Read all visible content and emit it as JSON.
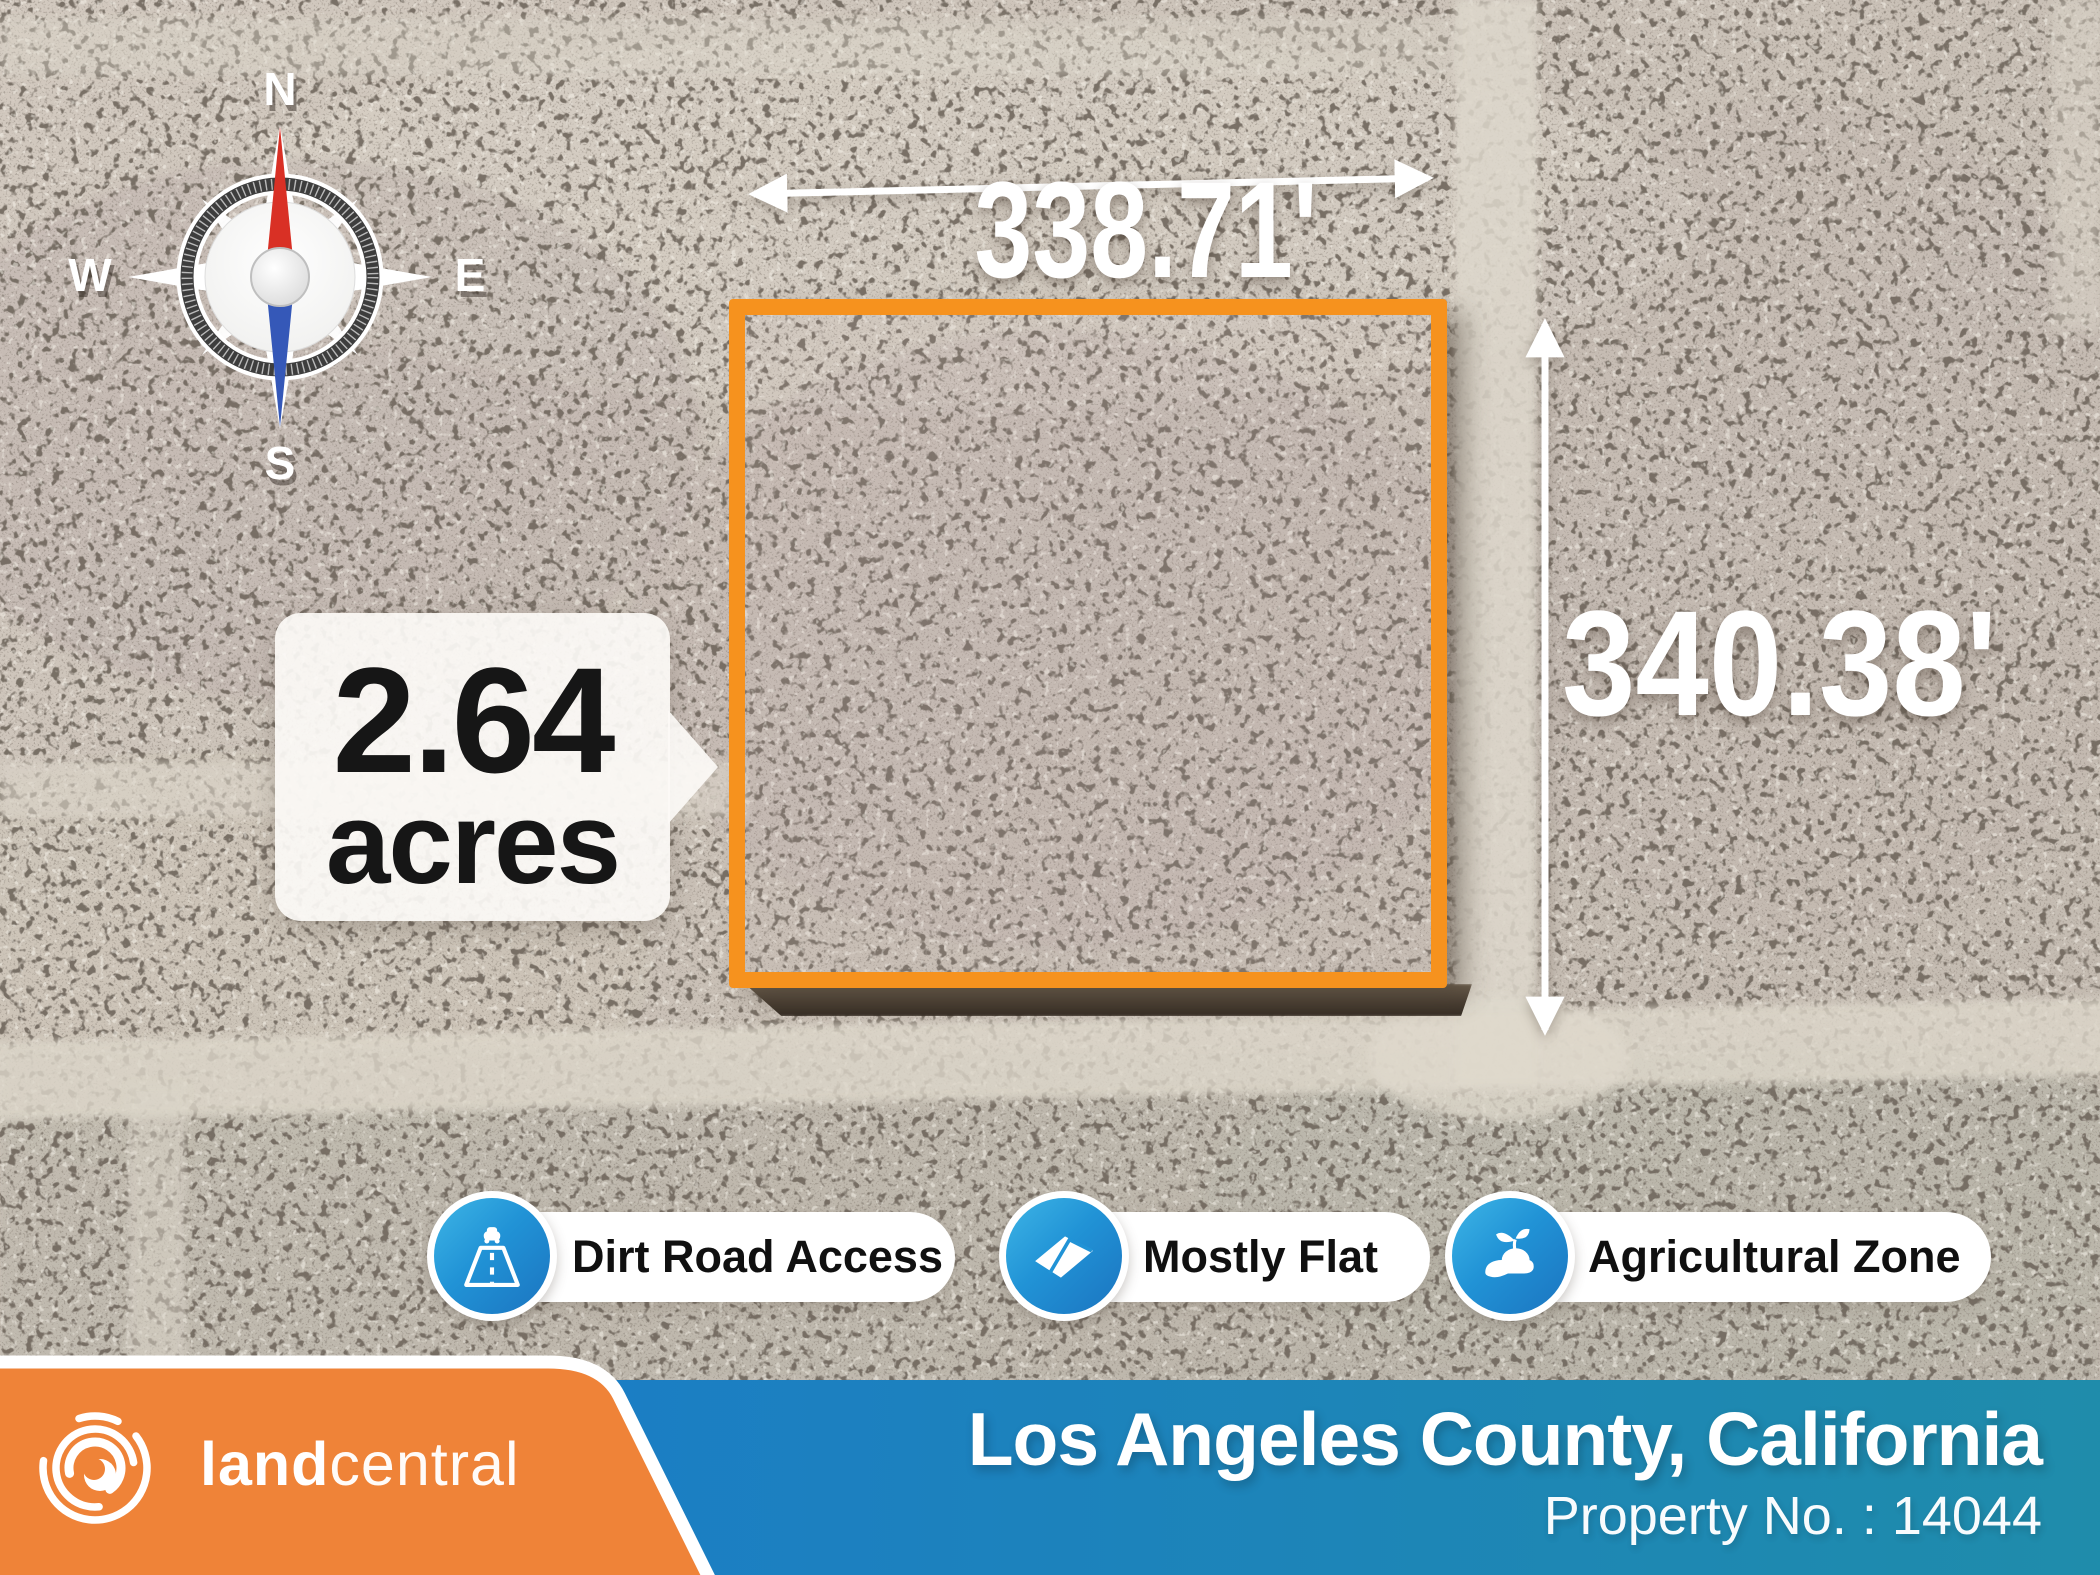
{
  "map": {
    "compass": {
      "n": "N",
      "e": "E",
      "s": "S",
      "w": "W"
    },
    "dimensions": {
      "top": "338.71'",
      "right": "340.38'"
    },
    "acreage": {
      "value": "2.64",
      "unit": "acres"
    },
    "parcel_outline_color": "#F6921E"
  },
  "badges": [
    {
      "label": "Dirt Road Access",
      "icon": "road-icon"
    },
    {
      "label": "Mostly Flat",
      "icon": "flat-land-icon"
    },
    {
      "label": "Agricultural Zone",
      "icon": "hand-sprout-icon"
    }
  ],
  "footer": {
    "brand": {
      "name_bold": "land",
      "name_light": "central",
      "icon": "landcentral-swirl-logo"
    },
    "location_title": "Los Angeles County, California",
    "property_no": "Property No. : 14044",
    "orange": "#EF8338",
    "blue_left": "#1B7EC4",
    "blue_right": "#1F8CAB"
  },
  "colors": {
    "ground": "#CBC2B8",
    "speckle": "#2A241E",
    "road": "#DDD7CB",
    "badge_blue_light": "#3EB5E6",
    "badge_blue_dark": "#1B74C0",
    "needle_red": "#D93025",
    "needle_blue": "#3558B8"
  }
}
